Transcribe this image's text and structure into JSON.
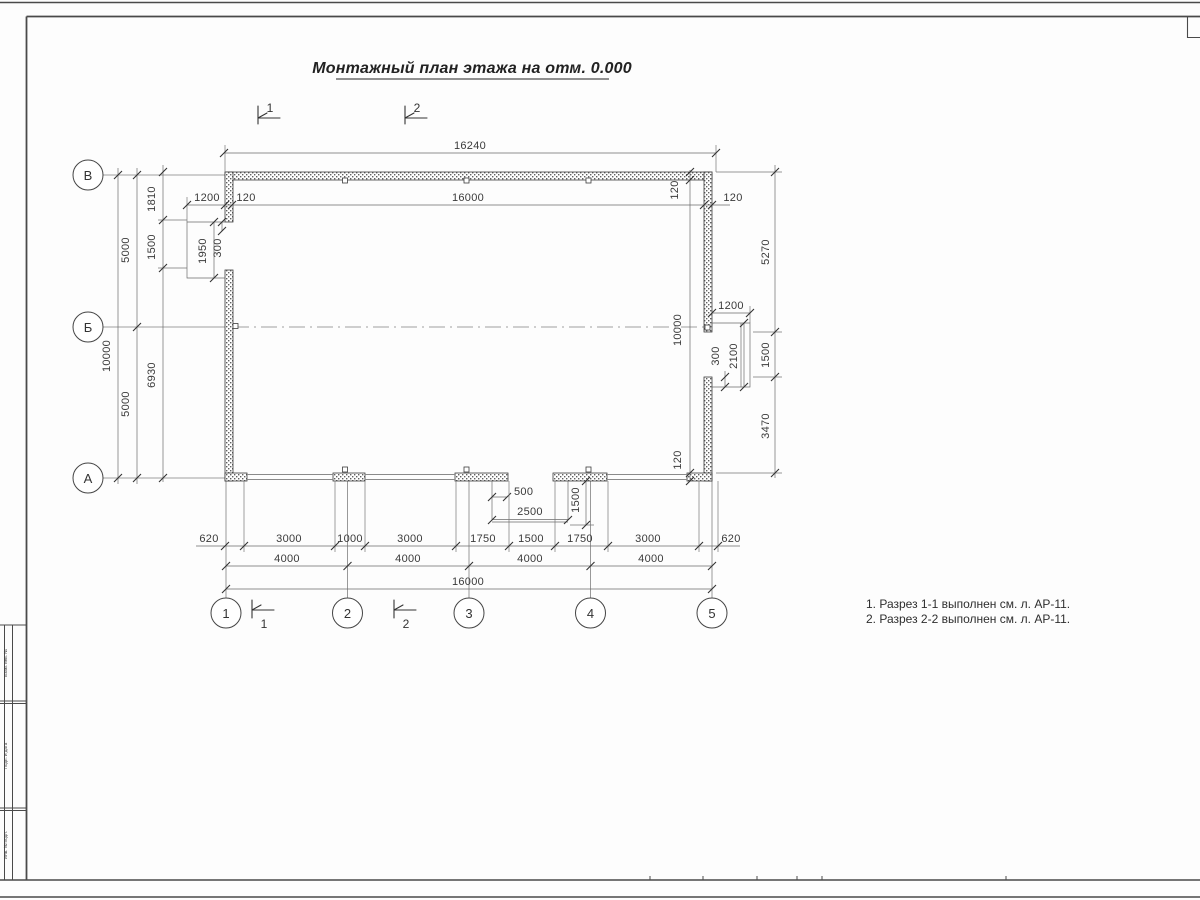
{
  "title": "Монтажный план этажа на отм. 0.000",
  "notes": {
    "line1": "1. Разрез 1-1 выполнен см. л. АР-11.",
    "line2": "2. Разрез 2-2 выполнен см. л. АР-11."
  },
  "axes": {
    "row_top": "В",
    "row_mid": "Б",
    "row_bottom": "А",
    "col1": "1",
    "col2": "2",
    "col3": "3",
    "col4": "4",
    "col5": "5"
  },
  "section_marks": {
    "top1": "1",
    "top2": "2",
    "bottom1": "1",
    "bottom2": "2"
  },
  "dims": {
    "overall_width": "16240",
    "top_1200": "1200",
    "top_120_left": "120",
    "axis_width": "16000",
    "top_120_right": "120",
    "left_10000": "10000",
    "left_5000_upper": "5000",
    "left_5000_lower": "5000",
    "left_1810": "1810",
    "left_1500": "1500",
    "left_6930": "6930",
    "niche_left_1950": "1950",
    "niche_left_300": "300",
    "right_120_top": "120",
    "right_10000": "10000",
    "right_120_bottom": "120",
    "right_5270": "5270",
    "right_1500": "1500",
    "right_3470": "3470",
    "niche_right_1200": "1200",
    "niche_right_2100": "2100",
    "niche_right_300": "300",
    "recess_500": "500",
    "recess_2500": "2500",
    "recess_1500": "1500",
    "b1": "620",
    "b2": "3000",
    "b3": "1000",
    "b4": "3000",
    "b5": "1750",
    "b6": "1500",
    "b7": "1750",
    "b8": "3000",
    "b9": "620",
    "s1": "4000",
    "s2": "4000",
    "s3": "4000",
    "s4": "4000",
    "bottom_16000": "16000"
  },
  "frame": {
    "stamp1": "Взам. инв. №",
    "stamp2": "Подп. и дата",
    "stamp3": "Инв. № подл."
  },
  "colors": {
    "line": "#444444",
    "dim": "#3a3a3a",
    "wall_dot": "#606060"
  }
}
